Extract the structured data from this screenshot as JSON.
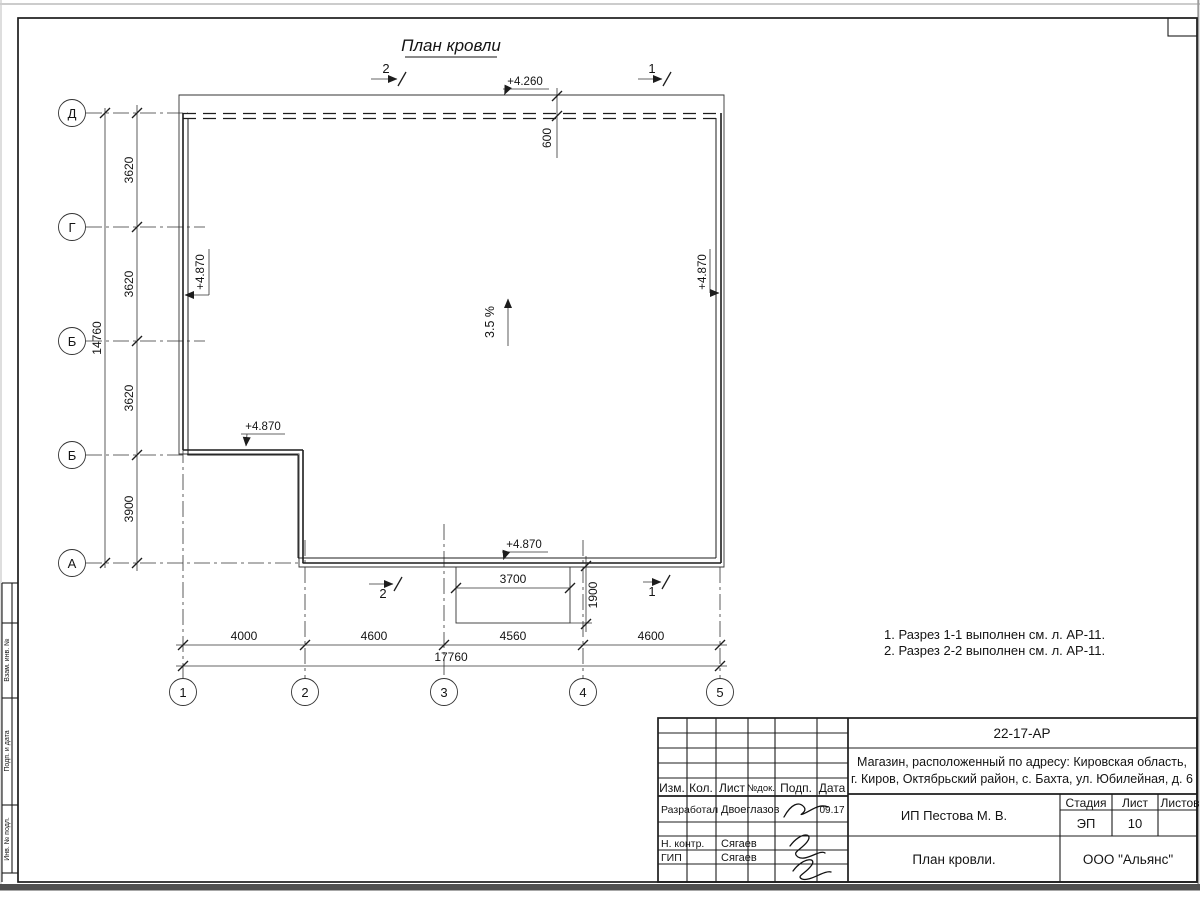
{
  "sheet": {
    "title": "План кровли"
  },
  "axes": {
    "rows": [
      "Д",
      "Г",
      "Б",
      "Б",
      "А"
    ],
    "cols": [
      "1",
      "2",
      "3",
      "4",
      "5"
    ]
  },
  "dims": {
    "left_segments": [
      "3620",
      "3620",
      "3620",
      "3900"
    ],
    "left_total": "14760",
    "bottom_segments": [
      "4000",
      "4600",
      "4560",
      "4600"
    ],
    "bottom_total": "17760",
    "overhang": "600",
    "canopy_width": "3700",
    "canopy_depth": "1900"
  },
  "elevations": {
    "roof_edge": "+4.260",
    "parapet": "+4.870"
  },
  "slope": {
    "label": "3.5 %"
  },
  "sections": {
    "mark1": "1",
    "mark2": "2"
  },
  "notes": {
    "items": [
      "1. Разрез 1-1 выполнен см. л. АР-11.",
      "2. Разрез 2-2 выполнен см. л. АР-11."
    ]
  },
  "titleblock": {
    "doc_number": "22-17-АР",
    "project_line1": "Магазин, расположенный по адресу: Кировская область,",
    "project_line2": "г. Киров, Октябрьский район, с. Бахта, ул. Юбилейная, д. 6",
    "client": "ИП Пестова М. В.",
    "sheet_title": "План кровли.",
    "company": "ООО \"Альянс\"",
    "stage_label": "Стадия",
    "sheet_label": "Лист",
    "sheets_label": "Листов",
    "stage_value": "ЭП",
    "sheet_value": "10",
    "sheets_value": "",
    "header_cols": [
      "Изм.",
      "Кол.",
      "Лист",
      "№док.",
      "Подп.",
      "Дата"
    ],
    "rows": [
      {
        "role": "Разработал",
        "name": "Двоеглазов",
        "date": "09.17"
      },
      {
        "role": "Н. контр.",
        "name": "Сягаев",
        "date": ""
      },
      {
        "role": "ГИП",
        "name": "Сягаев",
        "date": ""
      }
    ]
  },
  "side_stamp": {
    "labels": [
      "Взам. инв. №",
      "Подп. и дата",
      "Инв. № подл."
    ]
  }
}
